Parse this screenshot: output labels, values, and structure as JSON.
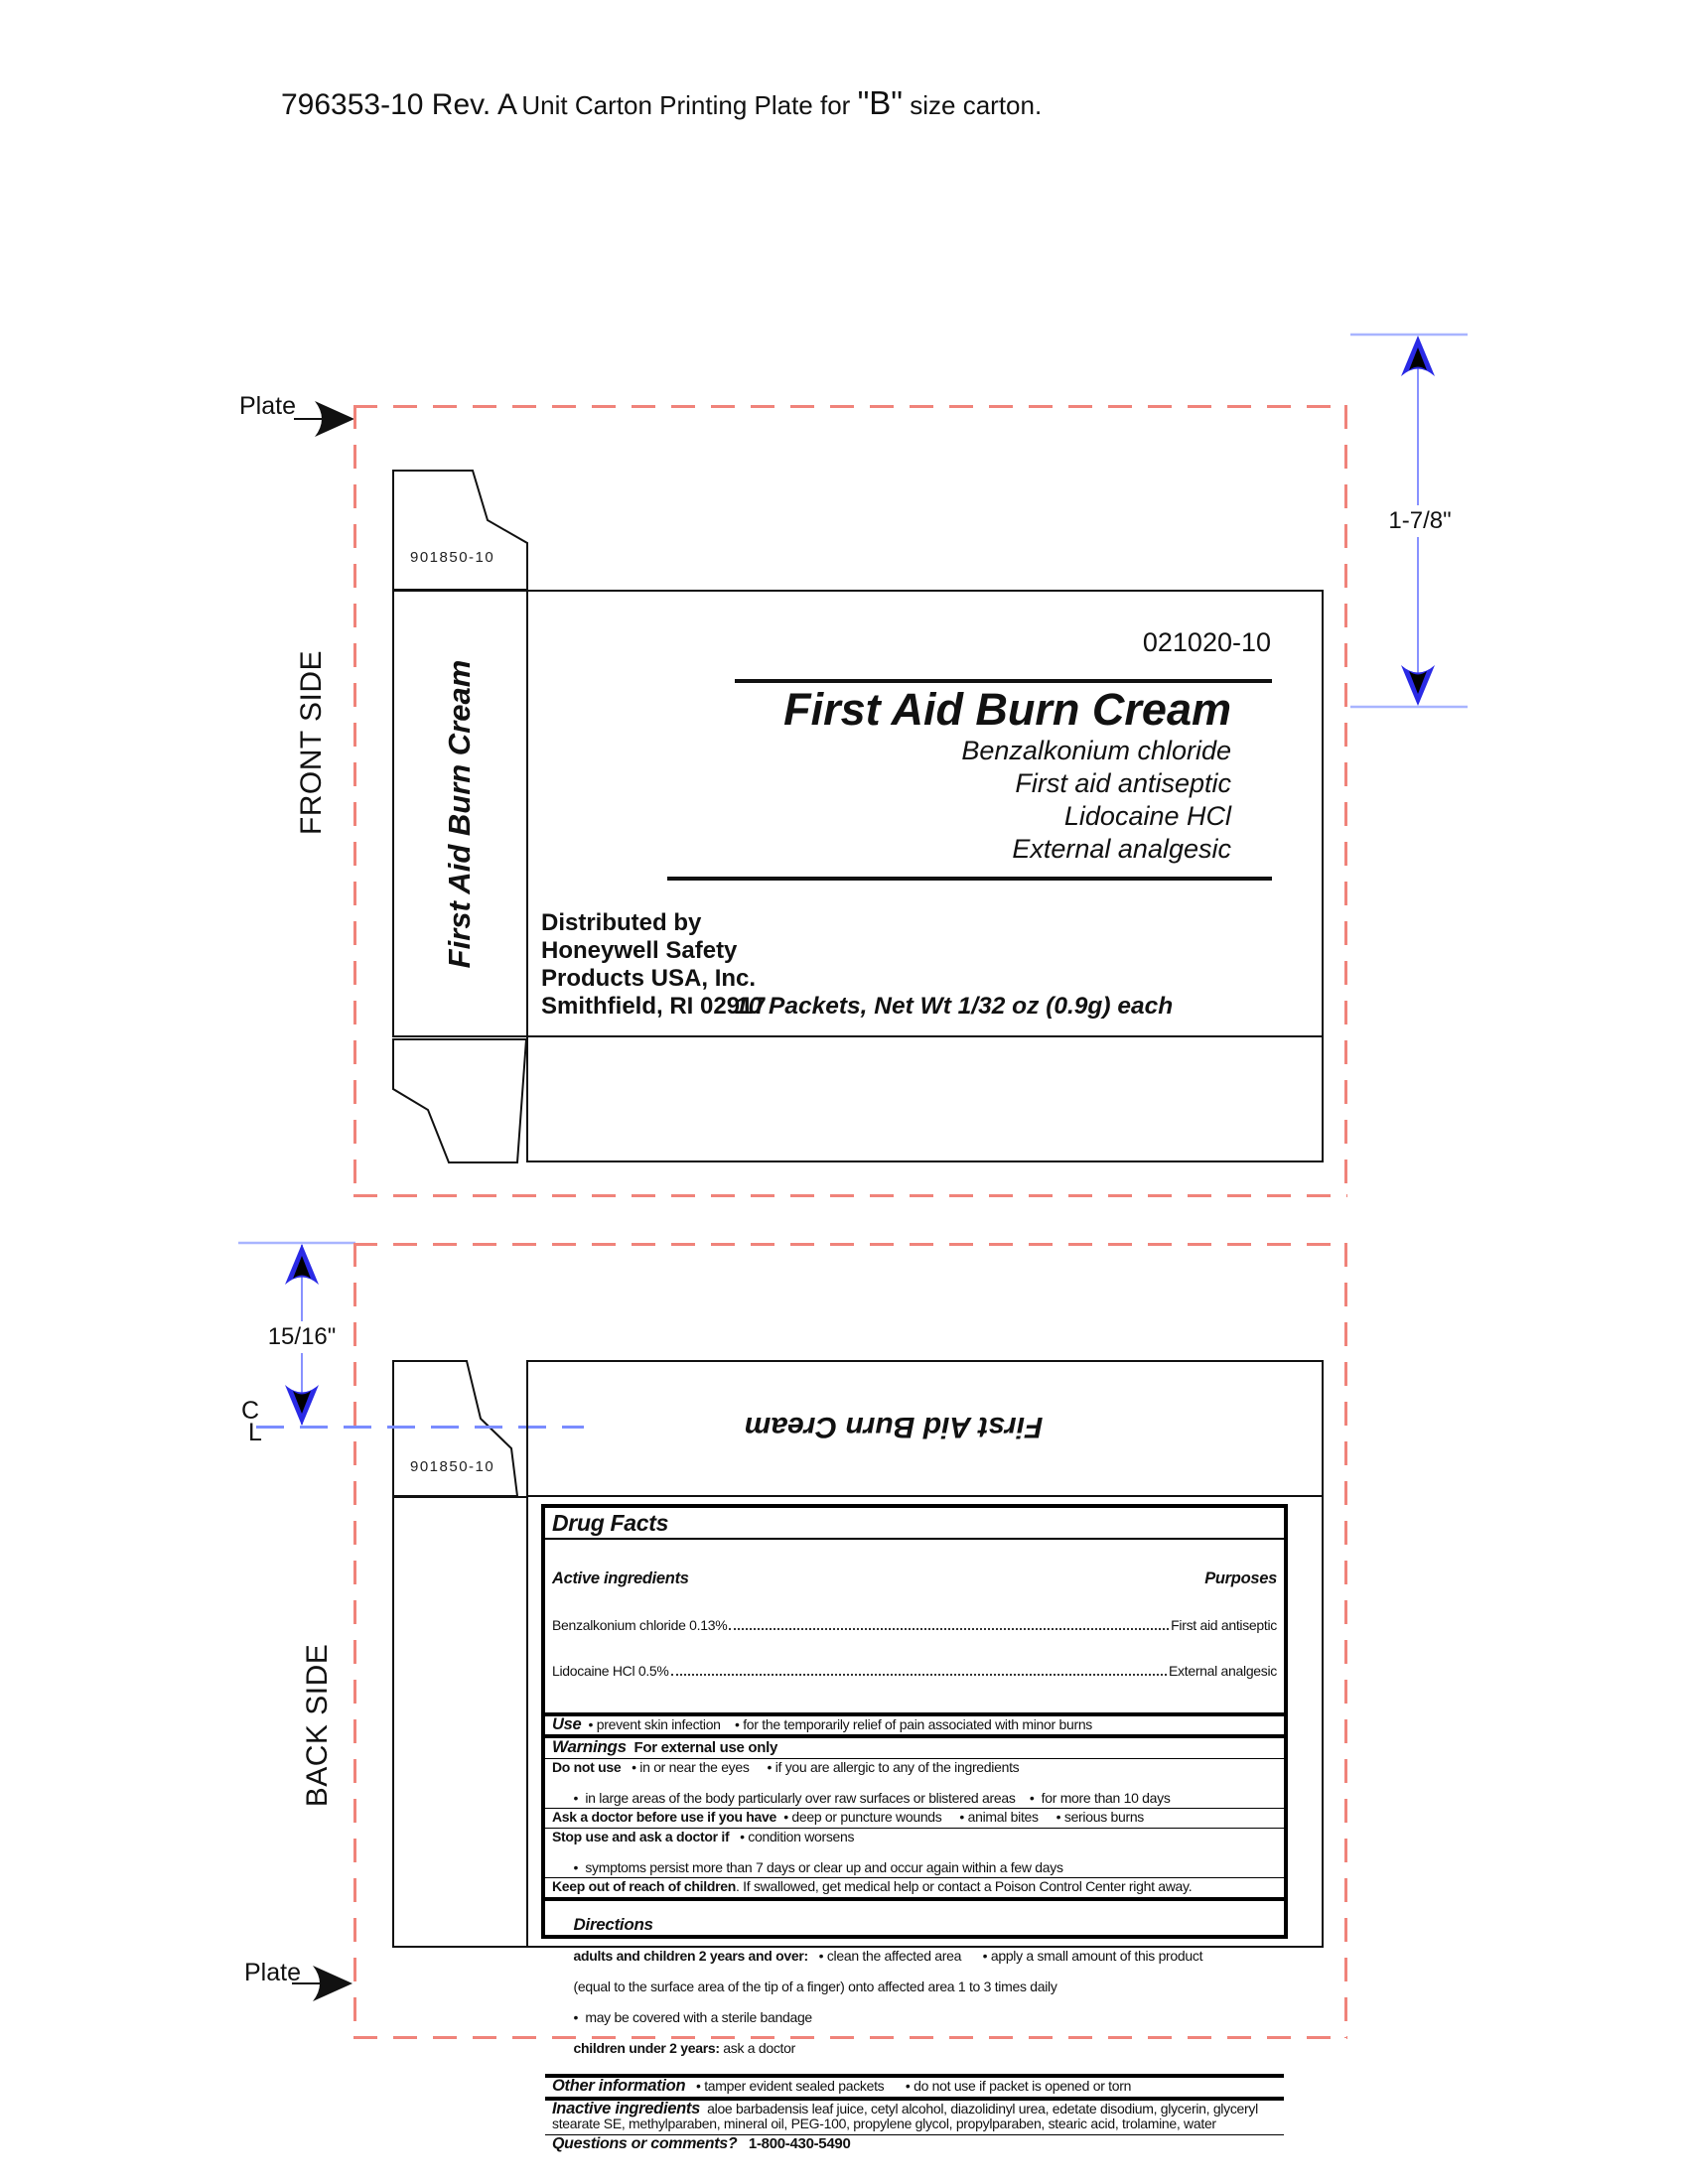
{
  "page": {
    "title_code": "796353-10 Rev. A",
    "title_mid": "Unit Carton Printing Plate for ",
    "title_b": "\"B\"",
    "title_end": " size carton."
  },
  "colors": {
    "red_dash": "#f0837a",
    "blue_dim": "#2a2ae6",
    "blue_line": "#8892ff",
    "blue_tick": "#a8b4ff",
    "blue_dash": "#7a8cff",
    "ink": "#111111"
  },
  "front": {
    "side_label": "FRONT SIDE",
    "plate_label": "Plate",
    "flap_code": "901850-10",
    "dim_label": "1-7/8\"",
    "spine_title": "First Aid Burn Cream",
    "panel": {
      "part_number": "021020-10",
      "title": "First Aid Burn Cream",
      "sub1": "Benzalkonium chloride",
      "sub2": "First aid antiseptic",
      "sub3": "Lidocaine HCl",
      "sub4": "External analgesic",
      "distributed": [
        "Distributed by",
        "Honeywell Safety",
        "Products USA, Inc.",
        "Smithfield, RI 02917"
      ],
      "net_wt": "10 Packets, Net Wt 1/32 oz (0.9g) each"
    }
  },
  "back": {
    "side_label": "BACK SIDE",
    "plate_label": "Plate",
    "flap_code": "901850-10",
    "dim_label": "15/16\"",
    "centerline_c": "C",
    "centerline_l": "L",
    "flipped_title": "First Aid Burn Cream",
    "drug_facts": {
      "title": "Drug Facts",
      "active_heading": "Active ingredients",
      "purposes_heading": "Purposes",
      "actives": [
        {
          "name": "Benzalkonium chloride 0.13%",
          "purpose": "First aid antiseptic"
        },
        {
          "name": "Lidocaine HCl 0.5%",
          "purpose": "External analgesic"
        }
      ],
      "use_label": "Use",
      "use_text": "  • prevent skin infection    • for the temporarily relief of pain associated with minor burns",
      "warnings_label": "Warnings",
      "warnings_sub": "  For external use only",
      "donotuse_label": "Do not use",
      "donotuse_text": "   • in or near the eyes     • if you are allergic to any of the ingredients",
      "donotuse_line2": "•  in large areas of the body particularly over raw surfaces or blistered areas    •  for more than 10 days",
      "askdoctor_label": "Ask a doctor before use if you have",
      "askdoctor_text": "  • deep or puncture wounds     • animal bites     • serious burns",
      "stopuse_label": "Stop use and ask a doctor if",
      "stopuse_text": "   • condition worsens",
      "stopuse_line2": "•  symptoms persist more than 7 days or clear up and occur again within a few days",
      "keepout_label": "Keep out of reach of children",
      "keepout_text": ". If swallowed, get medical help or contact a Poison Control Center right away.",
      "directions_label": "Directions",
      "directions_line1_label": "adults and children 2 years and over:",
      "directions_line1": "   • clean the affected area      • apply a small amount of this product",
      "directions_line2": "(equal to the surface area of the tip of a finger) onto affected area 1 to 3 times daily",
      "directions_line3": "•  may be covered with a sterile bandage",
      "directions_line4_label": "children under 2 years:",
      "directions_line4": " ask a doctor",
      "other_label": "Other information",
      "other_text": "   • tamper evident sealed packets      • do not use if packet is opened or torn",
      "inactive_label": "Inactive ingredients",
      "inactive_text": "  aloe barbadensis leaf juice, cetyl alcohol, diazolidinyl urea, edetate disodium, glycerin, glyceryl stearate SE, methylparaben, mineral oil, PEG-100, propylene glycol, propylparaben, stearic acid, trolamine, water",
      "questions_label": "Questions or comments?",
      "questions_phone": "   1-800-430-5490"
    }
  }
}
